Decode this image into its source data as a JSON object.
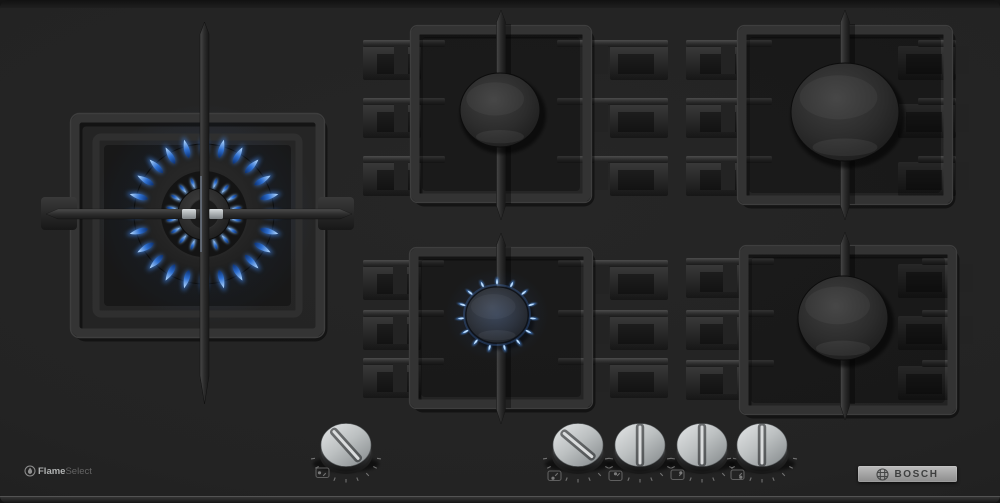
{
  "branding": {
    "bosch_label": "BOSCH",
    "flame_select_bold": "Flame",
    "flame_select_light": "Select"
  },
  "colors": {
    "surface": "#222222",
    "grate": "#2f2f2f",
    "flame_blue": "#4f93e8",
    "flame_deep": "#1d4f9e",
    "knob_silver": "#c4c6c5",
    "bosch_bar": "#a9a9a9",
    "bosch_text": "#3e3f3f"
  },
  "burners": [
    {
      "id": "wok-left",
      "label": "dual-ring wok burner",
      "state": "on",
      "flame_level": "high"
    },
    {
      "id": "top-middle",
      "label": "standard burner",
      "state": "off",
      "flame_level": "none"
    },
    {
      "id": "bottom-middle",
      "label": "economy burner",
      "state": "on",
      "flame_level": "simmer"
    },
    {
      "id": "top-right",
      "label": "high-power burner",
      "state": "off",
      "flame_level": "none"
    },
    {
      "id": "bottom-right",
      "label": "standard burner",
      "state": "off",
      "flame_level": "none"
    }
  ],
  "knobs": [
    {
      "id": "knob-wok-burner",
      "controls": "wok-left",
      "state": "on",
      "icon_dot": "center-left"
    },
    {
      "id": "knob-bottom-middle",
      "controls": "bottom-middle",
      "state": "on",
      "icon_dot": "bottom-center"
    },
    {
      "id": "knob-top-middle",
      "controls": "top-middle",
      "state": "off",
      "icon_dot": "top-center"
    },
    {
      "id": "knob-top-right",
      "controls": "top-right",
      "state": "off",
      "icon_dot": "top-right"
    },
    {
      "id": "knob-bottom-right",
      "controls": "bottom-right",
      "state": "off",
      "icon_dot": "bottom-right"
    }
  ]
}
